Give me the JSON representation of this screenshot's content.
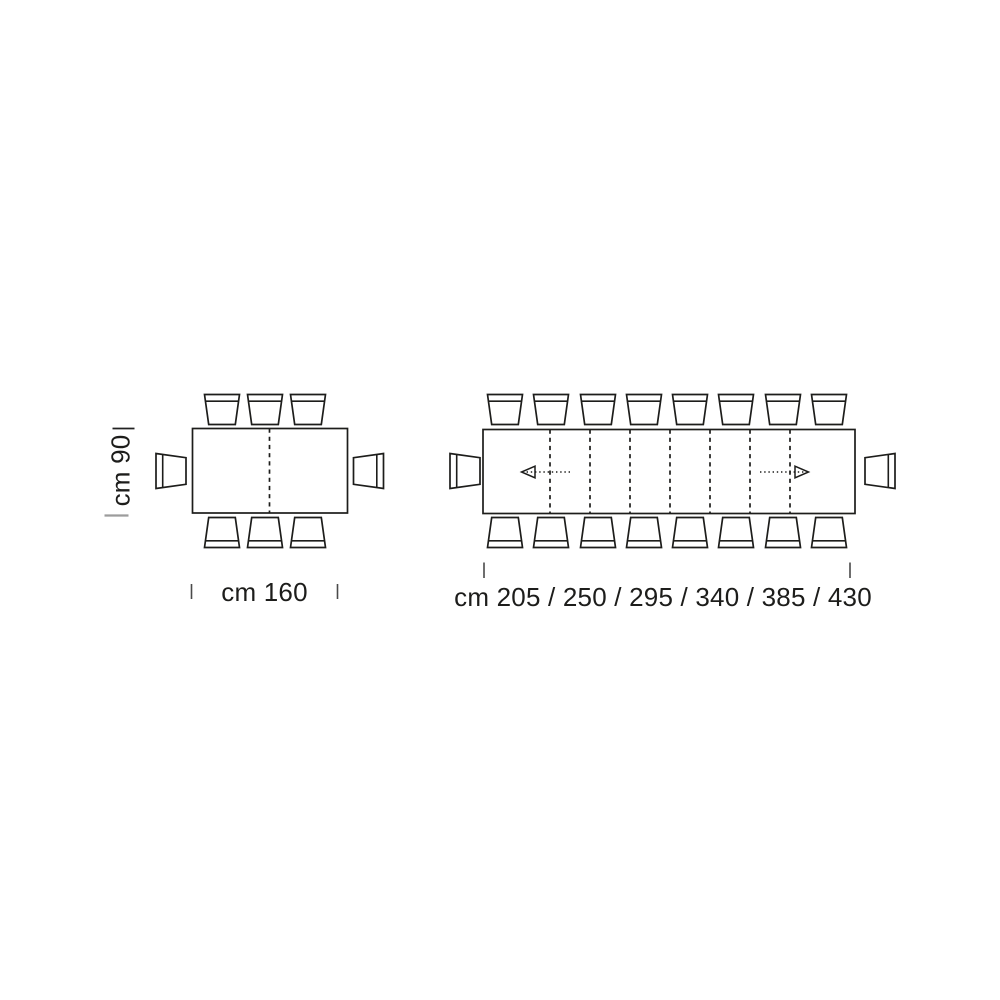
{
  "page": {
    "background_color": "#ffffff",
    "line_color": "#1d1d1b",
    "tick_color": "#4a4a4a",
    "muted_tick_color": "#9c9c9c"
  },
  "fixed_table": {
    "depth_label": "cm 90",
    "width_label": "cm 160",
    "seats": {
      "top": 3,
      "bottom": 3,
      "left": 1,
      "right": 1
    },
    "leaf_sections": 2
  },
  "extending_table": {
    "width_label": "cm 205 / 250 / 295 / 340 / 385 / 430",
    "widths_cm": [
      205,
      250,
      295,
      340,
      385,
      430
    ],
    "seats": {
      "top": 8,
      "bottom": 8,
      "left": 1,
      "right": 1
    },
    "leaf_sections": 8,
    "extension_direction_arrows": [
      "left",
      "right"
    ]
  }
}
